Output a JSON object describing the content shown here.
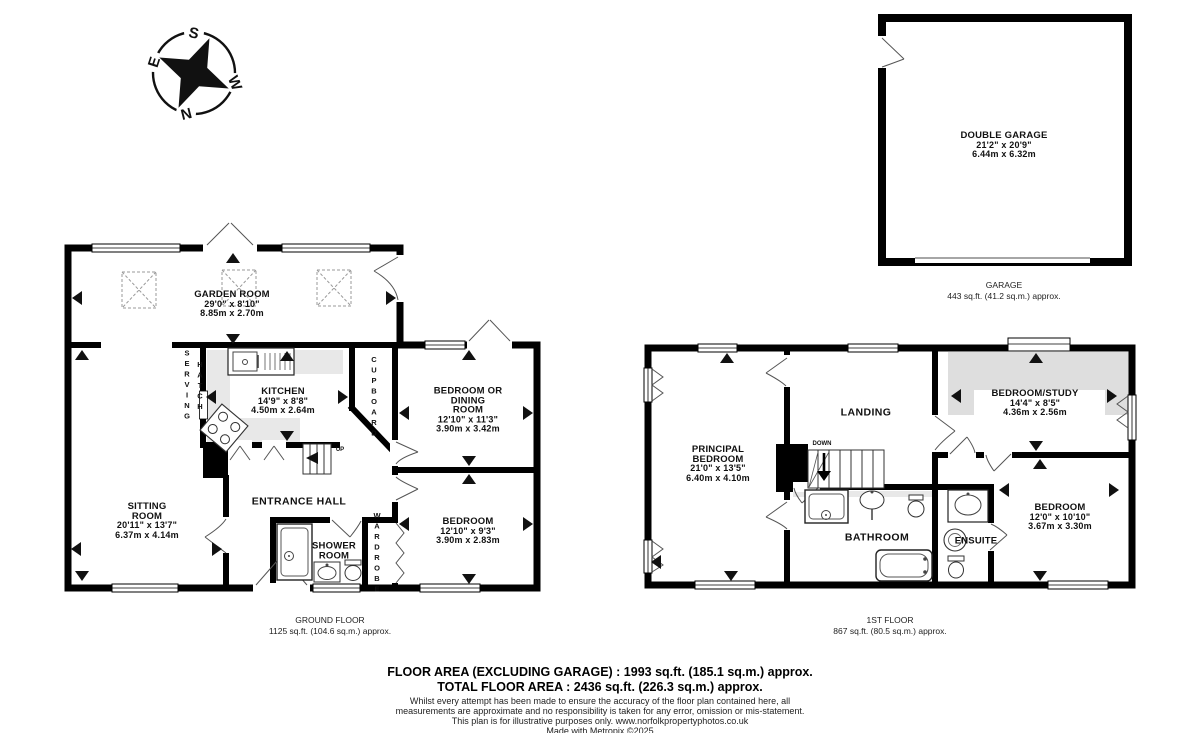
{
  "compass": {
    "n": "N",
    "s": "S",
    "e": "E",
    "w": "W"
  },
  "garage": {
    "room": {
      "name": "DOUBLE GARAGE",
      "imperial": "21'2\" x 20'9\"",
      "metric": "6.44m x 6.32m"
    },
    "caption": {
      "title": "GARAGE",
      "area": "443 sq.ft. (41.2 sq.m.) approx."
    }
  },
  "ground_floor": {
    "caption": {
      "title": "GROUND FLOOR",
      "area": "1125 sq.ft. (104.6 sq.m.) approx."
    },
    "stairs_label": "UP",
    "rooms": {
      "garden_room": {
        "name": "GARDEN ROOM",
        "imperial": "29'0\" x 8'10\"",
        "metric": "8.85m x 2.70m"
      },
      "kitchen": {
        "name": "KITCHEN",
        "imperial": "14'9\" x 8'8\"",
        "metric": "4.50m x 2.64m"
      },
      "bedroom_dining": {
        "name_lines": [
          "BEDROOM OR",
          "DINING",
          "ROOM"
        ],
        "imperial": "12'10\" x 11'3\"",
        "metric": "3.90m x 3.42m"
      },
      "bedroom": {
        "name": "BEDROOM",
        "imperial": "12'10\" x 9'3\"",
        "metric": "3.90m x 2.83m"
      },
      "sitting_room": {
        "name_lines": [
          "SITTING",
          "ROOM"
        ],
        "imperial": "20'11\" x 13'7\"",
        "metric": "6.37m x 4.14m"
      },
      "entrance_hall": {
        "name": "ENTRANCE HALL"
      },
      "shower_room": {
        "name_lines": [
          "SHOWER",
          "ROOM"
        ]
      },
      "serving_hatch": {
        "word1": "SERVING",
        "word2": "HATCH"
      },
      "cupboard": {
        "name": "CUPBOARD"
      },
      "wardrobe": {
        "name": "WARDROBE"
      }
    }
  },
  "first_floor": {
    "caption": {
      "title": "1ST FLOOR",
      "area": "867 sq.ft. (80.5 sq.m.) approx."
    },
    "stairs_label": "DOWN",
    "rooms": {
      "principal_bedroom": {
        "name_lines": [
          "PRINCIPAL",
          "BEDROOM"
        ],
        "imperial": "21'0\" x 13'5\"",
        "metric": "6.40m x 4.10m"
      },
      "landing": {
        "name": "LANDING"
      },
      "bedroom_study": {
        "name": "BEDROOM/STUDY",
        "imperial": "14'4\" x 8'5\"",
        "metric": "4.36m x 2.56m"
      },
      "bedroom": {
        "name": "BEDROOM",
        "imperial": "12'0\" x 10'10\"",
        "metric": "3.67m x 3.30m"
      },
      "bathroom": {
        "name": "BATHROOM"
      },
      "ensuite": {
        "name": "ENSUITE"
      }
    }
  },
  "footer": {
    "area_line1": "FLOOR AREA (EXCLUDING GARAGE) : 1993 sq.ft. (185.1 sq.m.) approx.",
    "area_line2": "TOTAL FLOOR AREA : 2436 sq.ft. (226.3 sq.m.) approx.",
    "disclaimer": [
      "Whilst every attempt has been made to ensure the accuracy of the floor plan contained here, all",
      "measurements are approximate and no responsibility is taken for any error, omission or mis-statement.",
      "This plan is for illustrative purposes only. www.norfolkpropertyphotos.co.uk"
    ],
    "credit": "Made with Metropix ©2025"
  }
}
